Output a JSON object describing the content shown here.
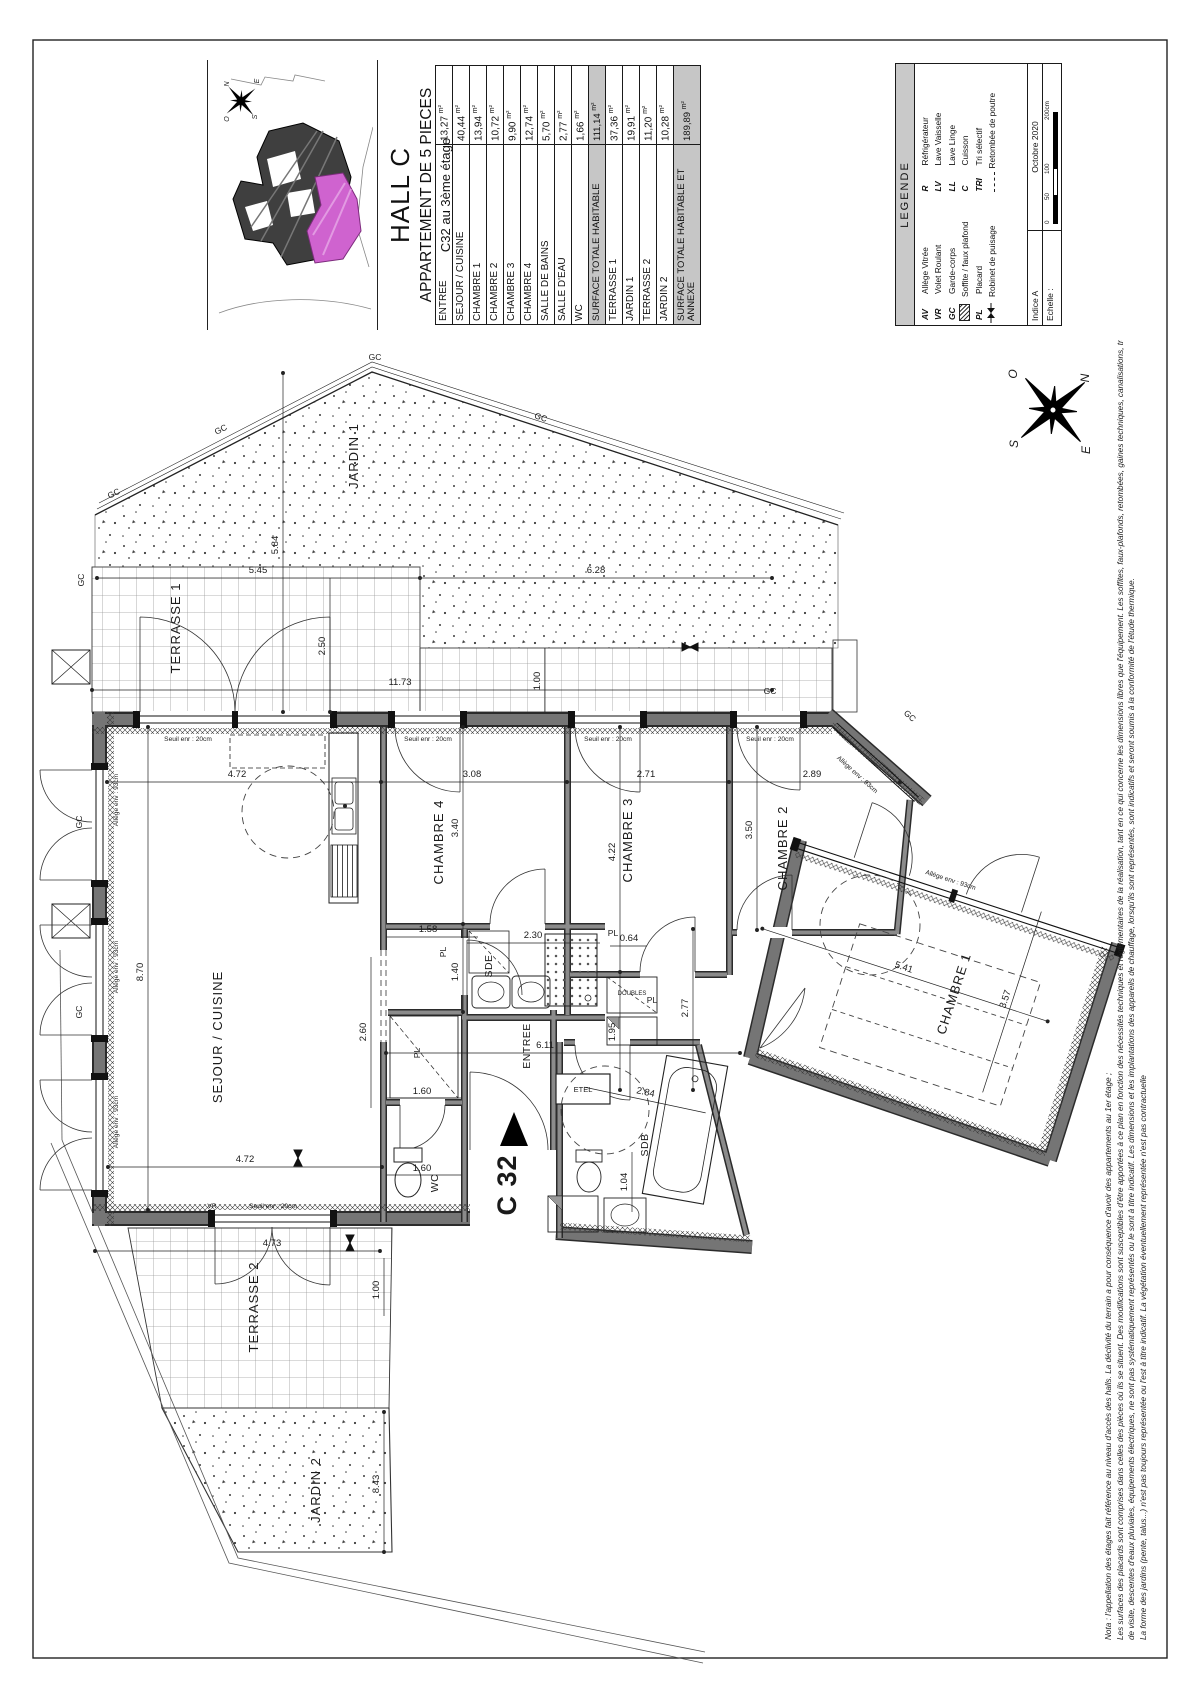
{
  "sheet": {
    "title": {
      "hall": "HALL C",
      "subtitle": "APPARTEMENT DE 5 PIECES",
      "location": "C32 au 3ème étage"
    },
    "areas": {
      "unit": "m²",
      "rows": [
        {
          "label": "ENTREE",
          "value": "13,27"
        },
        {
          "label": "SEJOUR / CUISINE",
          "value": "40,44"
        },
        {
          "label": "CHAMBRE 1",
          "value": "13,94"
        },
        {
          "label": "CHAMBRE 2",
          "value": "10,72"
        },
        {
          "label": "CHAMBRE 3",
          "value": "9,90"
        },
        {
          "label": "CHAMBRE 4",
          "value": "12,74"
        },
        {
          "label": "SALLE DE BAINS",
          "value": "5,70"
        },
        {
          "label": "SALLE D'EAU",
          "value": "2,77"
        },
        {
          "label": "WC",
          "value": "1,66"
        },
        {
          "label": "SURFACE TOTALE HABITABLE",
          "value": "111,14"
        },
        {
          "label": "TERRASSE 1",
          "value": "37,36"
        },
        {
          "label": "JARDIN 1",
          "value": "19,91"
        },
        {
          "label": "TERRASSE 2",
          "value": "11,20"
        },
        {
          "label": "JARDIN 2",
          "value": "10,28"
        },
        {
          "label": "SURFACE TOTALE HABITABLE ET ANNEXE",
          "value": "189,89"
        }
      ]
    },
    "legend": {
      "title": "LEGENDE",
      "left": [
        {
          "abbr": "AV",
          "label": "Allège Vitrée"
        },
        {
          "abbr": "VR",
          "label": "Volet Roulant"
        },
        {
          "abbr": "GC",
          "label": "Garde-corps"
        },
        {
          "abbr": "",
          "label": "Soffite / faux plafond"
        },
        {
          "abbr": "PL",
          "label": "Placard"
        },
        {
          "abbr": "",
          "label": "Robinet de puisage"
        }
      ],
      "right": [
        {
          "abbr": "R",
          "label": "Réfrigérateur"
        },
        {
          "abbr": "LV",
          "label": "Lave Vaisselle"
        },
        {
          "abbr": "LL",
          "label": "Lave Linge"
        },
        {
          "abbr": "C",
          "label": "Cuisson"
        },
        {
          "abbr": "TRI",
          "label": "Tri sélectif"
        },
        {
          "abbr": "",
          "label": "Retombée de poutre"
        }
      ],
      "indice": "Indice A",
      "date": "Octobre 2020",
      "scale_label": "Echelle :",
      "scale_ticks": [
        "0",
        "50",
        "100",
        "200cm"
      ]
    },
    "notes": [
      "Nota : l'appellation des étages fait référence au niveau d'accès des halls. La déclivité du terrain a pour conséquence d'avoir des appartements au 1er étage ;",
      "Les surfaces des placards sont comprises dans celles des pièces où ils se situent. Des modifications sont susceptibles d'être apportées à ce plan en fonction des nécessités techniques et réglementaires de la réalisation, tant en ce qui concerne les dimensions libres que l'équipement. Les soffites, faux-plafonds, retombées, gaines techniques, canalisations, trappes",
      "de visite, descentes d'eaux pluviales, équipements électriques, ne sont pas systématiquement représentés ou le sont à titre indicatif. Les dimensions et les implantations des appareils de chauffage, lorsqu'ils sont représentés, sont indicatifs et seront soumis à la conformité de l'étude thermique.",
      "La forme des jardins (pente, talus...) n'est pas toujours représentée ou l'est à titre indicatif. La végétation éventuellement représentée n'est pas contractuelle"
    ],
    "compass": {
      "n": "N",
      "e": "E",
      "s": "S",
      "o": "O"
    }
  },
  "plan": {
    "unit_label": "C 32",
    "rooms": {
      "sejour": "SEJOUR / CUISINE",
      "ch1": "CHAMBRE 1",
      "ch2": "CHAMBRE 2",
      "ch3": "CHAMBRE 3",
      "ch4": "CHAMBRE 4",
      "sde": "SDE",
      "sdb": "SDB",
      "wc": "WC",
      "entree": "ENTREE",
      "t1": "TERRASSE 1",
      "t2": "TERRASSE 2",
      "j1": "JARDIN 1",
      "j2": "JARDIN 2"
    },
    "small": {
      "gc": "GC",
      "vr": "VR",
      "seuil": "Seuil enr : 20cm",
      "allege": "Allège env : 93cm",
      "pl": "PL",
      "etel": "ETEL",
      "doubles": "DOUBLES"
    },
    "dims": {
      "t545": "5.45",
      "t628": "6.28",
      "t250": "2.50",
      "t584": "5.84",
      "t1173": "11.73",
      "t100": "1.00",
      "w472": "4.72",
      "w308": "3.08",
      "w271": "2.71",
      "w289": "2.89",
      "h870": "8.70",
      "h340": "3.40",
      "h140": "1.40",
      "h422": "4.22",
      "h195": "1.95",
      "h350": "3.50",
      "h277": "2.77",
      "s158": "1.58",
      "s230": "2.30",
      "s064": "0.64",
      "s260": "2.60",
      "s160a": "1.60",
      "s160b": "1.60",
      "s611": "6.11",
      "s104": "1.04",
      "b284": "2.84",
      "c541": "5.41",
      "c357": "3.57",
      "u472": "4.72",
      "u473": "4.73",
      "u100": "1.00",
      "u843": "8.43"
    }
  }
}
